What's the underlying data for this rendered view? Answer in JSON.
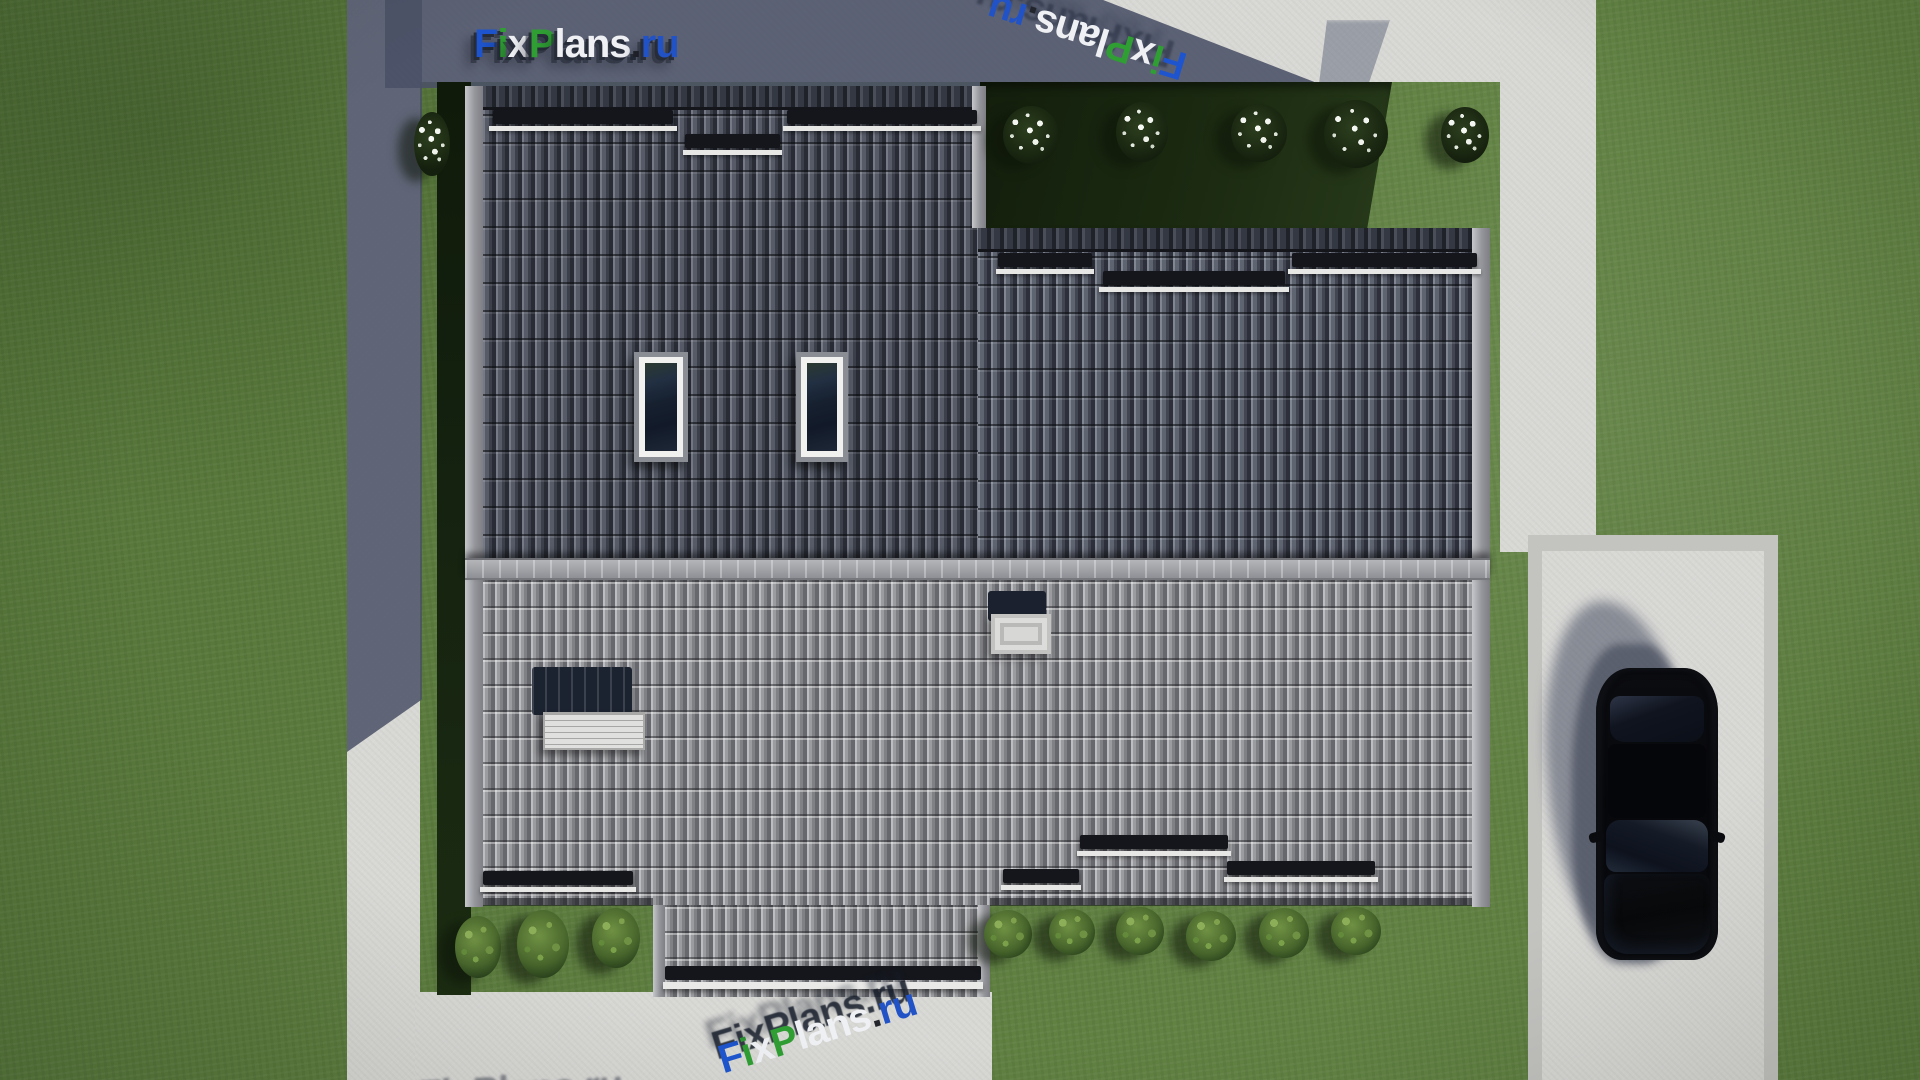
{
  "branding": {
    "site_name": "FixPlans.ru",
    "logo_segments": [
      {
        "text": "F",
        "color": "#1e55cf"
      },
      {
        "text": "i",
        "color": "#2f9e33"
      },
      {
        "text": "x",
        "color": "#eef0f4"
      },
      {
        "text": "P",
        "color": "#2f9e33"
      },
      {
        "text": "lans",
        "color": "#eef0f4"
      },
      {
        "text": ".",
        "color": "#23252c"
      },
      {
        "text": "ru",
        "color": "#2253c6"
      }
    ]
  },
  "watermarks": {
    "top_right": {
      "text": "FixPlans.ru",
      "rotation_deg": 197
    },
    "bottom_center": {
      "text": "FixPlans.ru",
      "rotation_deg": -17
    },
    "bottom_left_partial": {
      "text": "FixPlans.ru"
    }
  },
  "scene": {
    "description": "Top-down 3D architectural render of a house roof with yard, concrete paths, driveway and a parked car",
    "roof": {
      "upper_left_wing": {
        "tile_color": "#4a4e58",
        "skylights": 2,
        "snow_guards": 3
      },
      "upper_right_wing": {
        "tile_color": "#555a66",
        "snow_guards": 3
      },
      "lower_slope": {
        "tile_color": "#96979a",
        "snow_guards": 4,
        "chimneys": 1,
        "roof_hatches": 1
      },
      "porch_extension": {
        "tile_color": "#96979a",
        "gutter_color": "#e9e9e7"
      }
    },
    "landscape": {
      "grass_color": "#5d7d3e",
      "shaded_yard_color": "#1b2a11",
      "path_color": "#d8d8d5",
      "flowering_bushes": 6,
      "green_bushes": 9
    },
    "vehicle": {
      "type": "sedan-top-view",
      "color": "#0a0b0f"
    }
  }
}
